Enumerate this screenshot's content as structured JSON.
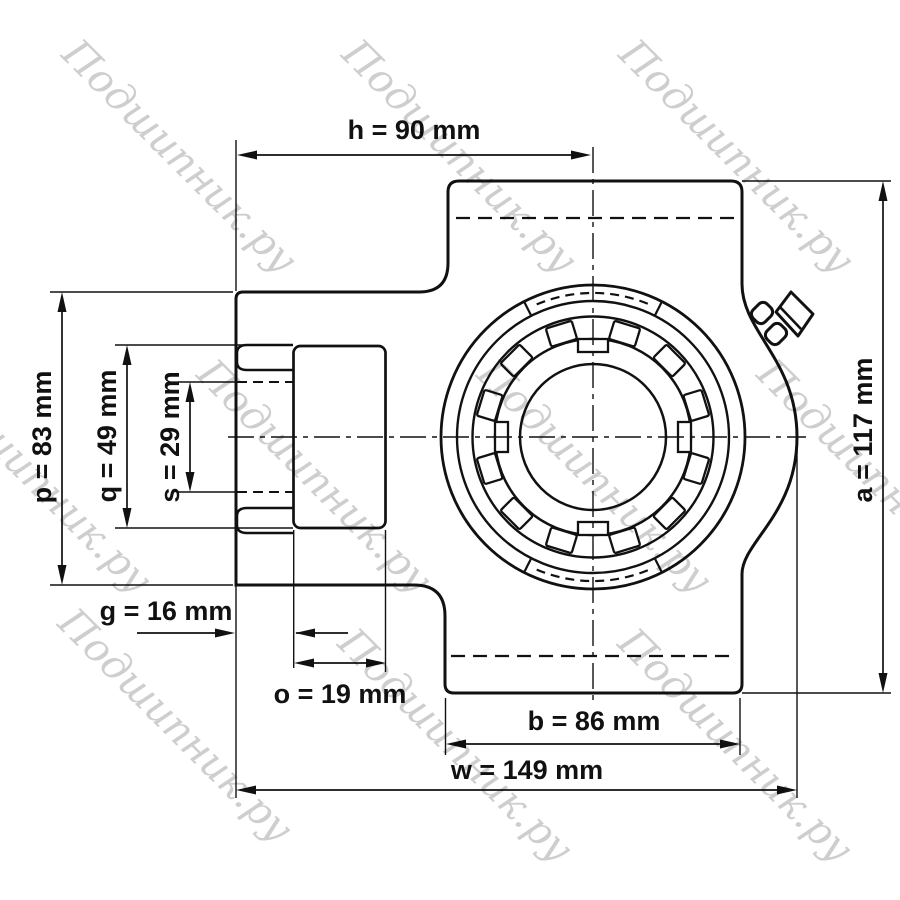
{
  "diagram": {
    "background": "#ffffff",
    "line_color": "#111111",
    "bore_fill": "#e0e0e0"
  },
  "dimensions": [
    {
      "name": "h",
      "value_mm": 90,
      "label": "h = 90 mm"
    },
    {
      "name": "p",
      "value_mm": 83,
      "label": "p = 83 mm"
    },
    {
      "name": "q",
      "value_mm": 49,
      "label": "q = 49 mm"
    },
    {
      "name": "s",
      "value_mm": 29,
      "label": "s = 29 mm"
    },
    {
      "name": "g",
      "value_mm": 16,
      "label": "g = 16 mm"
    },
    {
      "name": "o",
      "value_mm": 19,
      "label": "o = 19 mm"
    },
    {
      "name": "b",
      "value_mm": 86,
      "label": "b = 86 mm"
    },
    {
      "name": "w",
      "value_mm": 149,
      "label": "w = 149 mm"
    },
    {
      "name": "a",
      "value_mm": 117,
      "label": "a = 117 mm"
    }
  ],
  "watermark": {
    "text": "Подшипник.ру",
    "color": "#c9c9c9"
  }
}
